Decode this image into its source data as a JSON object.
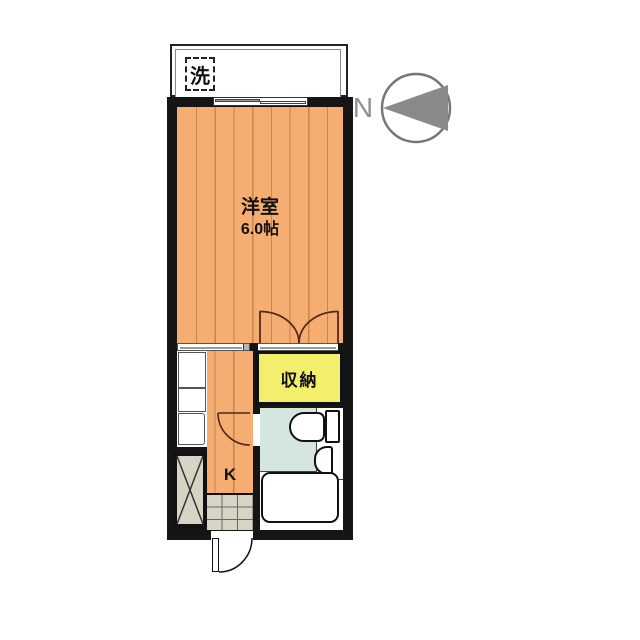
{
  "compass": {
    "north_label": "N"
  },
  "balcony": {
    "washer_label": "洗"
  },
  "rooms": {
    "main_room": {
      "name": "洋室",
      "size": "6.0帖"
    },
    "kitchen": {
      "label": "K"
    },
    "closet": {
      "label": "収納"
    }
  },
  "fixtures": {
    "washing_machine": "washing-machine-space",
    "kitchen_counter": "kitchen-counter",
    "refrigerator_space": "refrigerator-space",
    "toilet": "toilet",
    "wash_basin": "wash-basin",
    "bathtub": "bathtub",
    "entrance_tiles": "genkan-tiles"
  },
  "colors": {
    "wood_floor": "#F5AD72",
    "floor_seam": "#C9854C",
    "closet_fill": "#F3EF6D",
    "washroom_floor": "#D5E6DF",
    "tile_floor": "#D7D4C6",
    "wall": "#151515",
    "compass_gray": "#8A8A8A"
  }
}
